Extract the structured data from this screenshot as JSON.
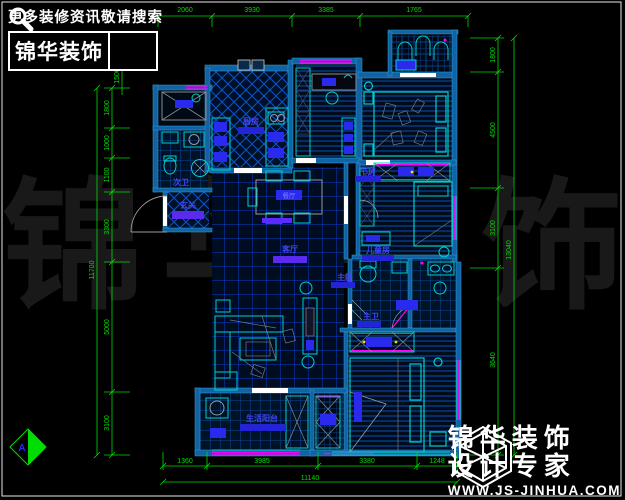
{
  "promo": {
    "line1": "更多装修资讯敬请搜索",
    "brand": "锦华装饰"
  },
  "footer": {
    "brand1": "锦华装饰",
    "brand2": "设计专家",
    "url": "WWW.JS-JINHUA.COM"
  },
  "watermark": {
    "c0": "锦",
    "c1": "华",
    "c2": "装",
    "c3": "饰"
  },
  "rooms": {
    "kitchen": "厨房",
    "guest_bath": "次卫",
    "entry": "玄关",
    "study": "书房",
    "kids": "儿童房",
    "living": "客厅",
    "dining": "餐厅",
    "master": "主卧",
    "master_bath": "主卫",
    "balcony": "生活阳台"
  },
  "dims": {
    "top": [
      "2060",
      "3930",
      "3385",
      "1765"
    ],
    "bottom": [
      "1360",
      "3985",
      "3380",
      "1248"
    ],
    "bottom_total": "11140",
    "left": [
      "1800",
      "1000",
      "1100",
      "3300",
      "5000",
      "3100"
    ],
    "left_total": "11700",
    "left_upper": "1500",
    "right": [
      "1800",
      "4500",
      "3100",
      "3640"
    ],
    "right_total": "13040",
    "marker": "A"
  },
  "colors": {
    "wall": "#1263a5",
    "accent_cyan": "#00d0cc",
    "window_magenta": "#ff00ff",
    "dim_green": "#00dd00",
    "label_blue": "#4343ff",
    "fixture_blue": "#2a2aee"
  }
}
